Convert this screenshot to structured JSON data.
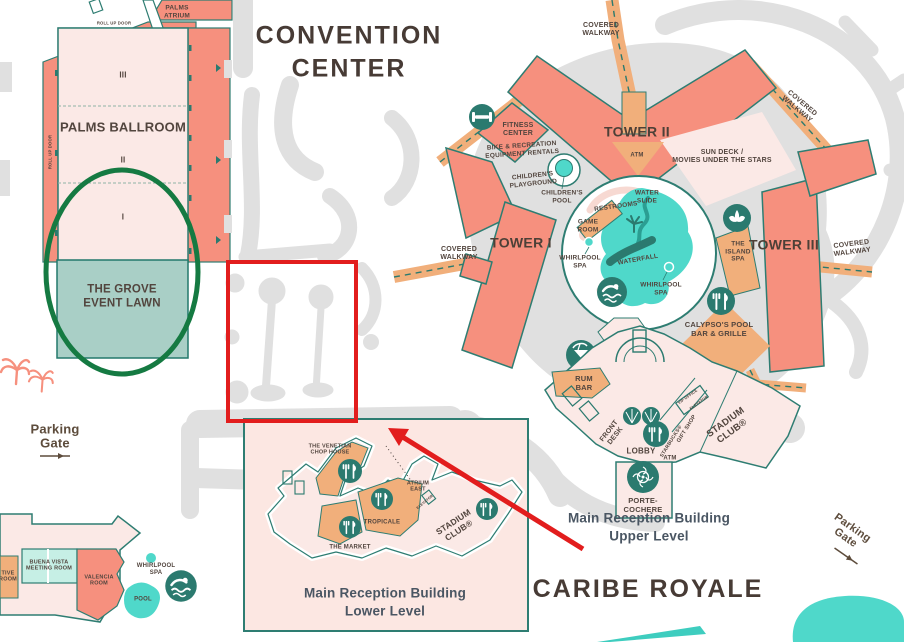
{
  "titles": {
    "convention": "CONVENTION\nCENTER",
    "resort": "CARIBE ROYALE"
  },
  "convention_center": {
    "palms_atrium": "PALMS\nATRIUM",
    "roll_up_door_top": "ROLL UP DOOR",
    "roll_up_door_left": "ROLL UP DOOR",
    "ballroom": "PALMS BALLROOM",
    "section_3": "III",
    "section_2": "II",
    "section_1": "I",
    "grove": "THE GROVE\nEVENT LAWN"
  },
  "walkways": {
    "top": "COVERED\nWALKWAY",
    "top_right": "COVERED\nWALKWAY",
    "left": "COVERED\nWALKWAY",
    "right": "COVERED\nWALKWAY"
  },
  "towers": {
    "t1": "TOWER I",
    "t2": "TOWER II",
    "t3": "TOWER III",
    "sun_deck": "SUN DECK /\nMOVIES UNDER THE STARS",
    "atm": "ATM"
  },
  "pool_area": {
    "fitness": "FITNESS\nCENTER",
    "bike": "BIKE & RECREATION\nEQUIPMENT RENTALS",
    "playground": "CHILDREN'S\nPLAYGROUND",
    "childrens_pool": "CHILDREN'S\nPOOL",
    "water_slide": "WATER\nSLIDE",
    "restrooms": "RESTROOMS",
    "game_room": "GAME\nROOM",
    "whirlpool_left": "WHIRLPOOL\nSPA",
    "waterfall": "WATERFALL",
    "whirlpool_right": "WHIRLPOOL\nSPA",
    "island_spa": "THE\nISLAND\nSPA",
    "calypsos": "CALYPSO'S POOL\nBAR & GRILLE"
  },
  "reception_upper": {
    "rum_bar": "RUM\nBAR",
    "front_desk": "FRONT\nDESK",
    "lobby": "LOBBY",
    "starbucks": "STARBUCKS®",
    "gift_shop": "GIFT SHOP",
    "atm": "ATM",
    "vip_office": "VIP OFFICE",
    "elevator": "ELEVATOR",
    "stadium_club": "STADIUM\nCLUB®",
    "porte_cochere": "PORTE-\nCOCHERE",
    "caption": "Main Reception Building\nUpper Level"
  },
  "reception_lower": {
    "venetian": "THE VENETIAN\nCHOP HOUSE",
    "atrium_east": "ATRIUM\nEAST",
    "elevator": "ELEVATOR",
    "tropicale": "TROPICALE",
    "market": "THE MARKET",
    "stadium_club": "STADIUM\nCLUB®",
    "caption": "Main Reception Building\nLower Level"
  },
  "south_area": {
    "parking_left": "Parking\nGate",
    "parking_right": "Parking\nGate",
    "buena_vista": "BUENA VISTA\nMEETING ROOM",
    "valencia": "VALENCIA\nROOM",
    "clipped_room": "TIVE\nROOM",
    "whirlpool": "WHIRLPOOL\nSPA",
    "pool": "POOL"
  },
  "colors": {
    "building_salmon": "#F6907E",
    "building_pink": "#FBE9E6",
    "walkway_orange": "#F1AF7B",
    "teal_dark": "#2B7A6F",
    "water_turquoise": "#4FD8CA",
    "grove_teal": "#A9CFC6",
    "meeting_mint": "#C6EFE5",
    "road_gray": "#E0E0E0",
    "annotation_red": "#E21D1D",
    "annotation_green": "#157A42"
  }
}
